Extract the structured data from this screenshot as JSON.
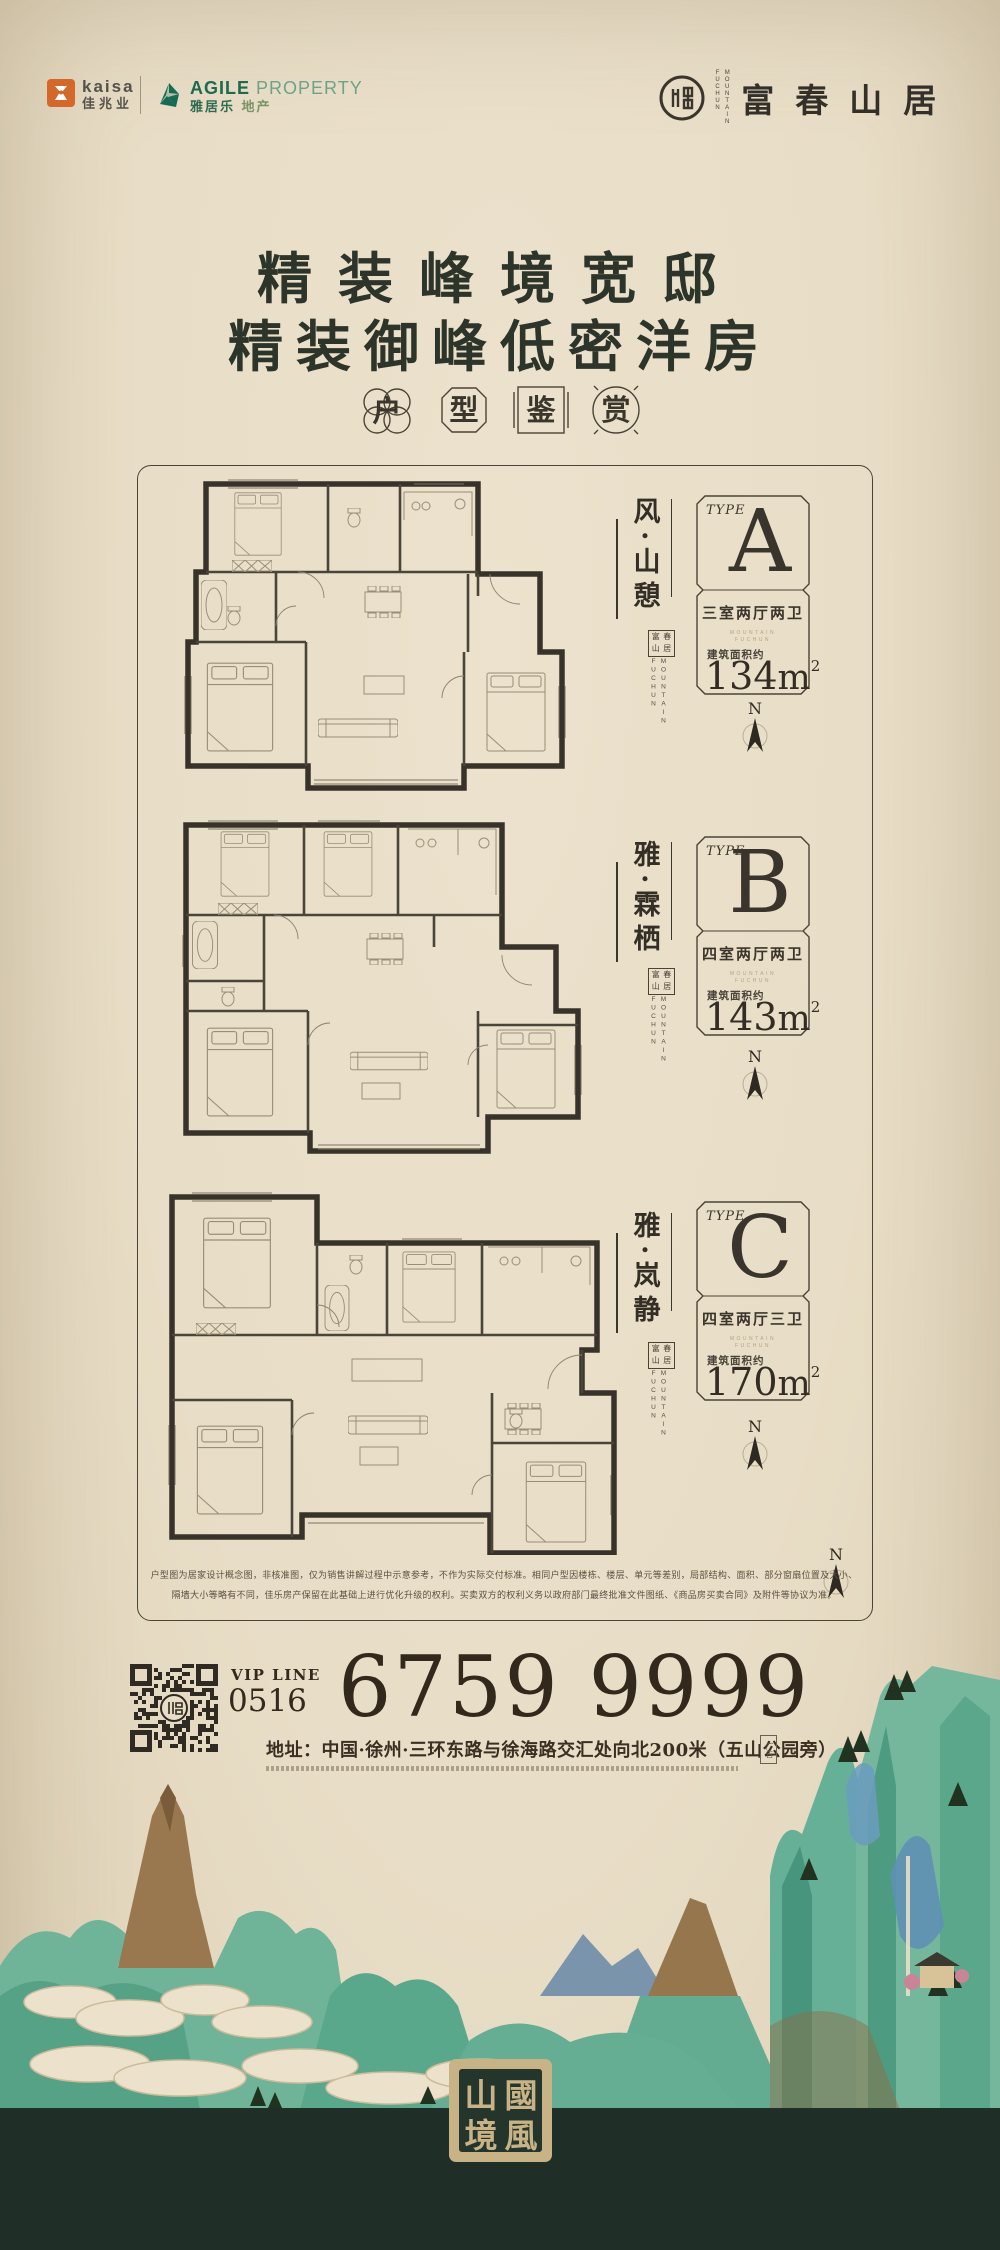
{
  "page": {
    "title": "富春山居 精装户型鉴赏海报"
  },
  "header": {
    "kaisa": {
      "en": "kaisa",
      "cn": "佳兆业"
    },
    "agile": {
      "en": "AGILE",
      "en_suffix": "PROPERTY",
      "cn": "雅居乐",
      "cn_suffix": "地产"
    },
    "brand": {
      "cn": "富春山居",
      "en_col1": "MOUNTAIN",
      "en_col2": "FUCHUN"
    }
  },
  "headline": {
    "line1": "精装峰境宽邸",
    "line2": "精装御峰低密洋房"
  },
  "subtitle": {
    "chars": [
      "户",
      "型",
      "鉴",
      "赏"
    ]
  },
  "compass": {
    "label": "N"
  },
  "plans": [
    {
      "name_vertical": "风·山憩",
      "type_label": "TYPE",
      "type": "A",
      "rooms": "三室两厅两卫",
      "area_label": "建筑面积约",
      "area_number": "134",
      "area_unit": "m",
      "area_sup": "2",
      "seal_chars": [
        "富",
        "春",
        "山",
        "居"
      ],
      "en_col1": "FUCHUN",
      "en_col2": "MOUNTAIN",
      "sub_en1": "MOUNTAIN",
      "sub_en2": "FUCHUN"
    },
    {
      "name_vertical": "雅·霖栖",
      "type_label": "TYPE",
      "type": "B",
      "rooms": "四室两厅两卫",
      "area_label": "建筑面积约",
      "area_number": "143",
      "area_unit": "m",
      "area_sup": "2",
      "seal_chars": [
        "富",
        "春",
        "山",
        "居"
      ],
      "en_col1": "FUCHUN",
      "en_col2": "MOUNTAIN",
      "sub_en1": "MOUNTAIN",
      "sub_en2": "FUCHUN"
    },
    {
      "name_vertical": "雅·岚静",
      "type_label": "TYPE",
      "type": "C",
      "rooms": "四室两厅三卫",
      "area_label": "建筑面积约",
      "area_number": "170",
      "area_unit": "m",
      "area_sup": "2",
      "seal_chars": [
        "富",
        "春",
        "山",
        "居"
      ],
      "en_col1": "FUCHUN",
      "en_col2": "MOUNTAIN",
      "sub_en1": "MOUNTAIN",
      "sub_en2": "FUCHUN"
    }
  ],
  "disclaimer": {
    "line1": "户型图为居家设计概念图，非核准图，仅为销售讲解过程中示意参考，不作为实际交付标准。相同户型因楼栋、楼层、单元等差别，局部结构、面积、部分窗扇位置及大小、",
    "line2": "隔墙大小等略有不同，佳乐房产保留在此基础上进行优化升级的权利。买卖双方的权利义务以政府部门最终批准文件图纸、《商品房买卖合同》及附件等协议为准。"
  },
  "contact": {
    "vip_label": "VIP LINE",
    "area_code": "0516",
    "phone": "6759 9999",
    "address": "地址：中国·徐州·三环东路与徐海路交汇处向北200米（五山公园旁）",
    "ad_mark": "广告"
  },
  "footer": {
    "seal": {
      "tl": "山",
      "tr": "國",
      "bl": "境",
      "br": "風"
    }
  },
  "colors": {
    "paper": "#e8ddc6",
    "ink": "#332e26",
    "headline_green": "#2d352b",
    "kaisa_orange": "#d4682a",
    "agile_green": "#1d6a4e",
    "mountain_teal": "#6fb399",
    "mountain_blue": "#5e90b4",
    "footer_green": "#1f2f28",
    "seal_beige": "#c8b386",
    "phone_brown": "#32281c"
  }
}
